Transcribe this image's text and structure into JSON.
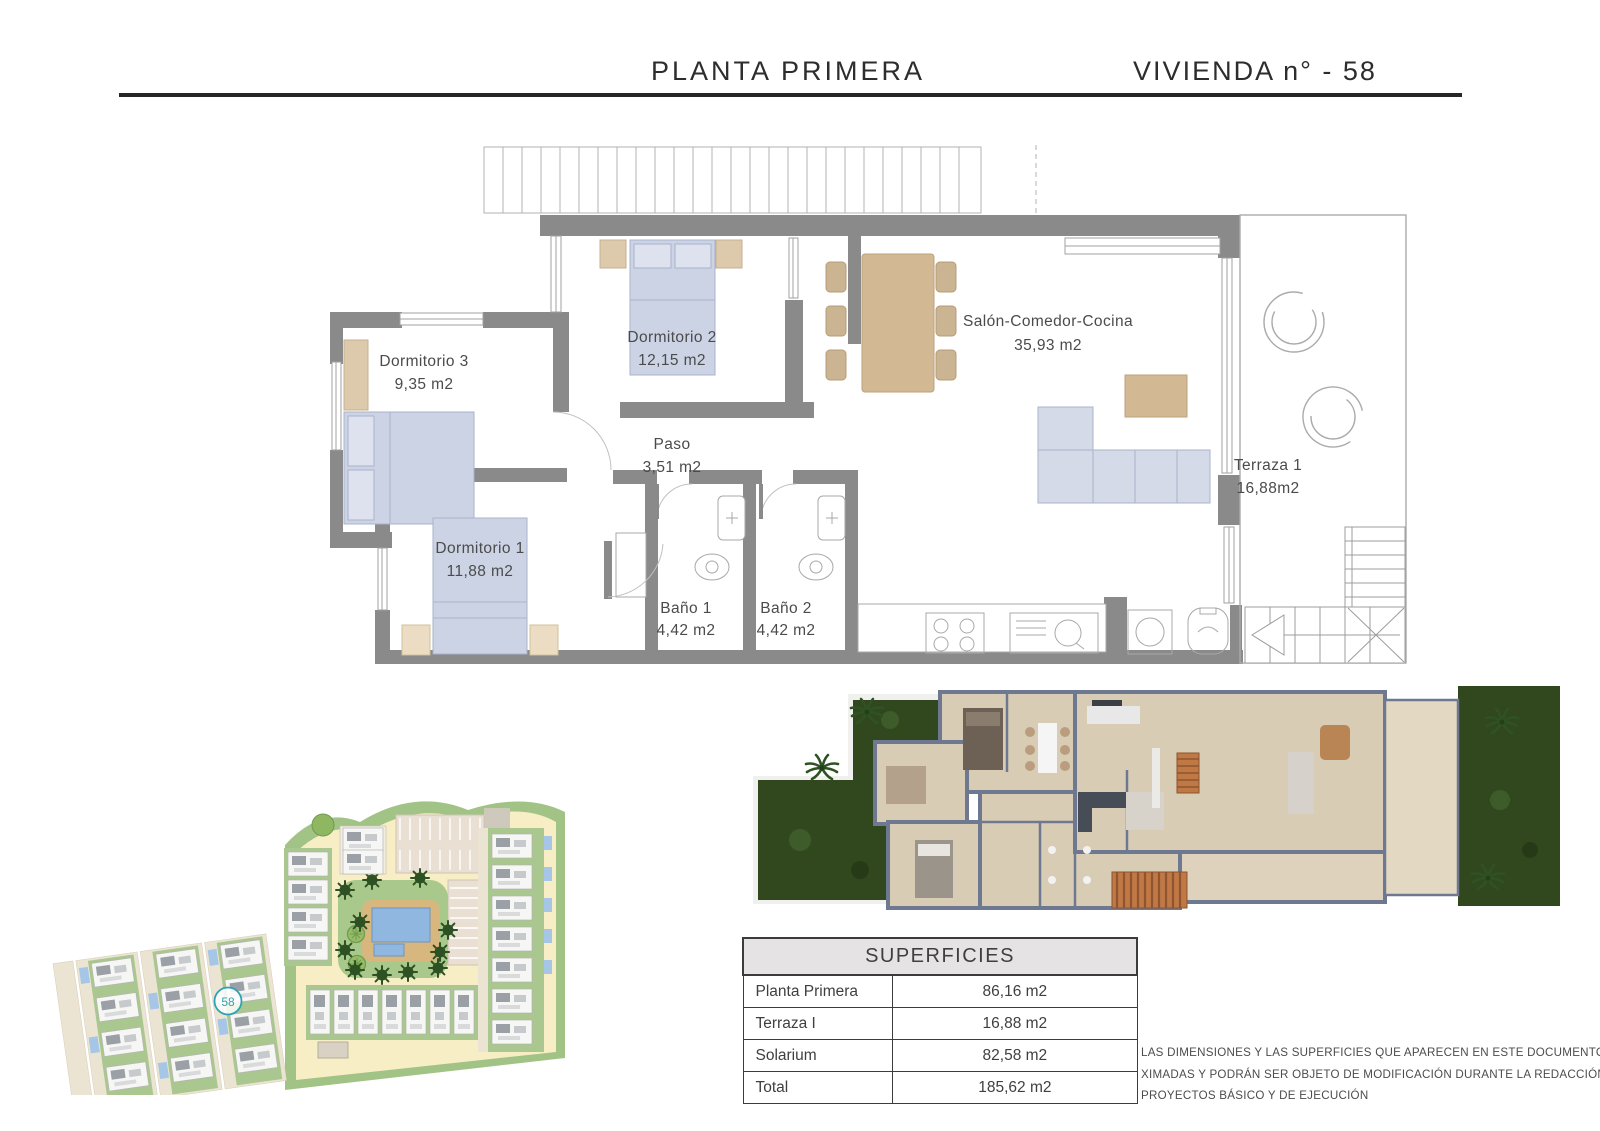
{
  "header": {
    "title": "PLANTA PRIMERA",
    "unit": "VIVIENDA n° - 58"
  },
  "floorplan": {
    "rooms": [
      {
        "name": "Dormitorio 3",
        "area": "9,35 m2"
      },
      {
        "name": "Dormitorio 2",
        "area": "12,15 m2"
      },
      {
        "name": "Paso",
        "area": "3,51 m2"
      },
      {
        "name": "Salón-Comedor-Cocina",
        "area": "35,93 m2"
      },
      {
        "name": "Dormitorio 1",
        "area": "11,88 m2"
      },
      {
        "name": "Baño 1",
        "area": "4,42 m2"
      },
      {
        "name": "Baño 2",
        "area": "4,42 m2"
      },
      {
        "name": "Terraza 1",
        "area": "16,88m2"
      }
    ]
  },
  "site_plan": {
    "unit_marker": "58"
  },
  "table": {
    "title": "SUPERFICIES",
    "rows": [
      {
        "label": "Planta Primera",
        "value": "86,16 m2"
      },
      {
        "label": "Terraza I",
        "value": "16,88 m2"
      },
      {
        "label": "Solarium",
        "value": "82,58 m2"
      },
      {
        "label": "Total",
        "value": "185,62 m2"
      }
    ]
  },
  "disclaimer": {
    "lines": [
      "LAS DIMENSIONES Y LAS SUPERFICIES QUE APARECEN EN ESTE DOCUMENTO SON APRO-",
      "XIMADAS Y PODRÁN SER OBJETO DE MODIFICACIÓN DURANTE LA REDACCIÓN DE LOS",
      "PROYECTOS BÁSICO Y DE EJECUCIÓN"
    ]
  },
  "colors": {
    "accent_marker_teal": "#2ba3b4",
    "wall_gray": "#8a8a8a",
    "furniture_blue": "#ccd3e4",
    "furniture_tan": "#d8c5a8",
    "site_road_yellow": "#f7eec6",
    "site_grass_green": "#a9c78e",
    "pool_blue": "#8fb7e0",
    "render_wall": "#6e7890",
    "render_floor": "#d9ccb4",
    "garden_dark_green": "#31481e",
    "pergola_orange": "#c07844"
  }
}
